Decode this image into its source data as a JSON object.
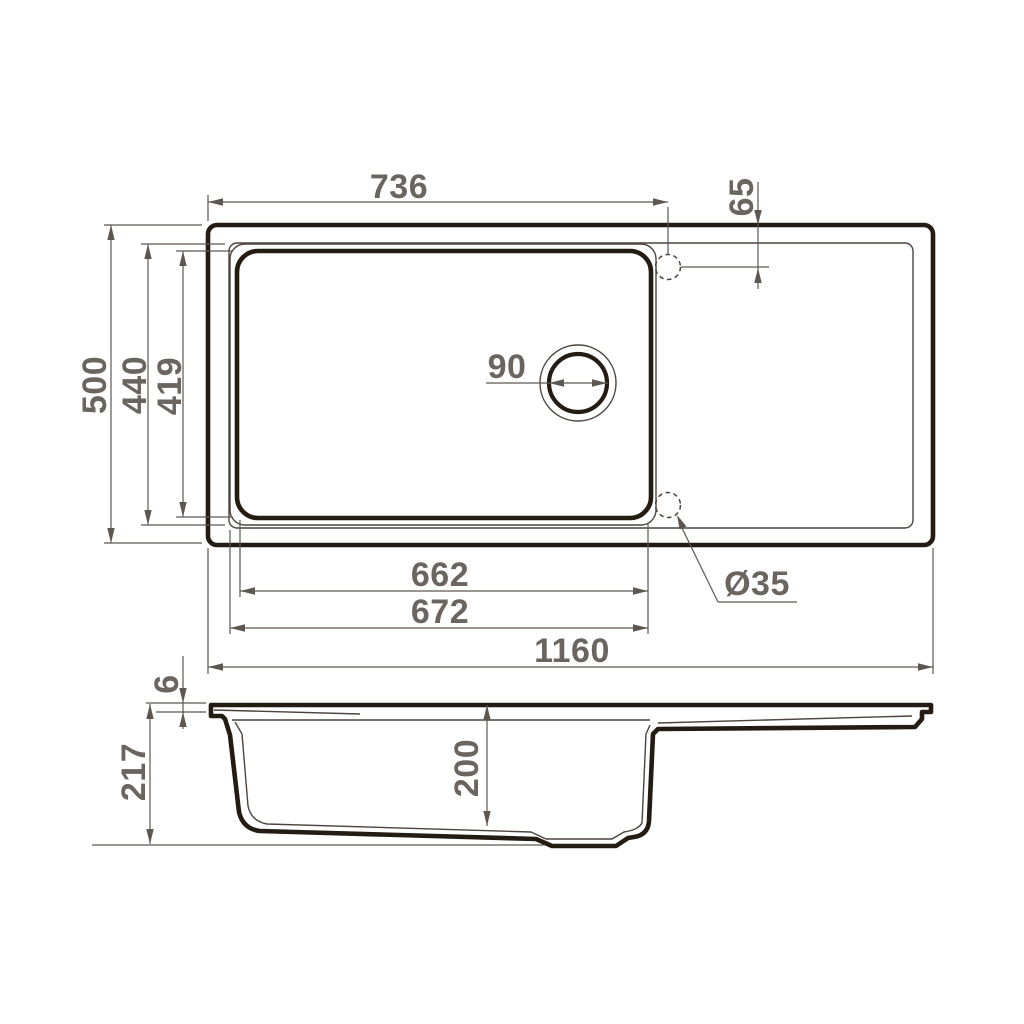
{
  "colors": {
    "outline": "#241b13",
    "thin_line": "#4c443e",
    "dimension_line": "#5d5751",
    "label_text": "#6b6560",
    "background": "#ffffff"
  },
  "top_view": {
    "dims": {
      "top_width": "736",
      "hole_offset": "65",
      "overall_depth": "500",
      "bowl_opening_depth": "440",
      "bowl_inner_depth": "419",
      "drain_diameter": "90",
      "bowl_inner_width": "662",
      "bowl_outer_width": "672",
      "overall_width": "1160",
      "hole_diameter": "Ø35"
    }
  },
  "side_view": {
    "dims": {
      "rim_thickness": "6",
      "overall_height": "217",
      "bowl_depth": "200"
    }
  }
}
